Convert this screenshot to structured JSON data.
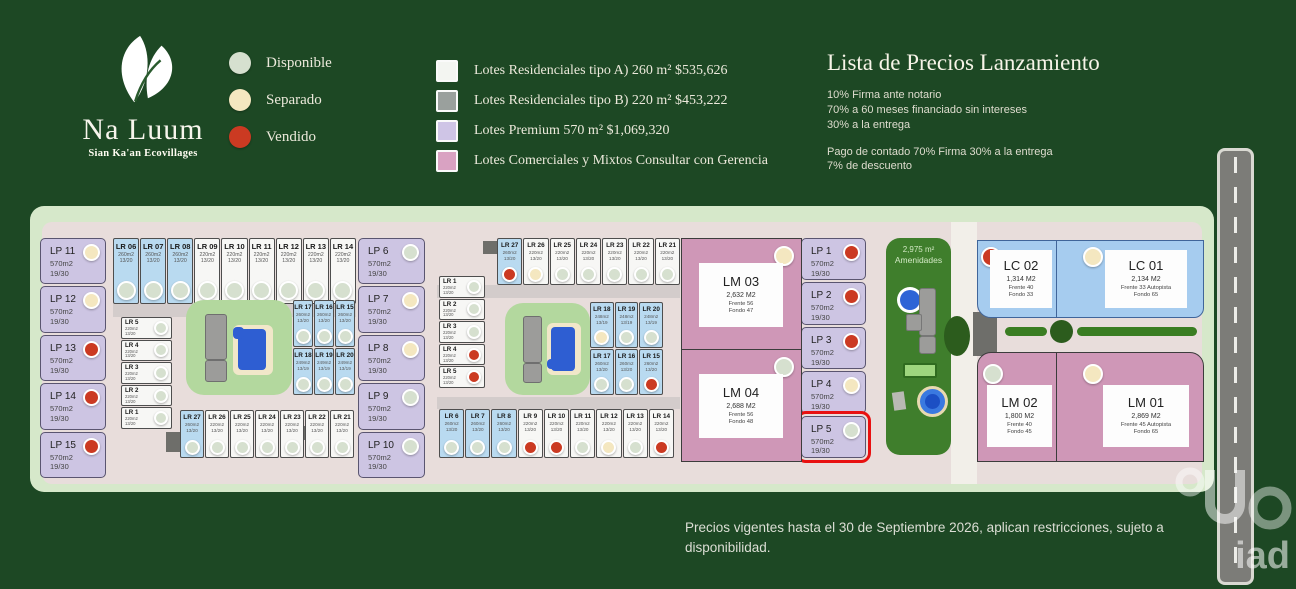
{
  "logo": {
    "title": "Na Luum",
    "subtitle": "Sian Ka'an Ecovillages"
  },
  "status_legend": [
    {
      "label": "Disponible",
      "status": "disponible"
    },
    {
      "label": "Separado",
      "status": "separado"
    },
    {
      "label": "Vendido",
      "status": "vendido"
    }
  ],
  "type_legend": [
    {
      "label": "Lotes Residenciales tipo A)  260 m² $535,626",
      "color": "#f3f5f1"
    },
    {
      "label": "Lotes Residenciales tipo B)  220 m² $453,222",
      "color": "#9aa09d"
    },
    {
      "label": "Lotes Premium 570 m² $1,069,320",
      "color": "#cfc5e6"
    },
    {
      "label": "Lotes Comerciales y Mixtos Consultar con Gerencia",
      "color": "#d9a2c2"
    }
  ],
  "price_list": {
    "title": "Lista de Precios Lanzamiento",
    "lines_1": [
      "10% Firma ante notario",
      "70% a 60 meses  financiado sin intereses",
      "30% a la  entrega"
    ],
    "lines_2": [
      "Pago de contado 70% Firma 30% a la entrega",
      "7% de descuento"
    ]
  },
  "footer": "Precios vigentes hasta el 30 de Septiembre 2026, aplican restricciones, sujeto a disponibilidad.",
  "watermark": "iad",
  "colors": {
    "background": "#1d4824",
    "site": "#d6e8ca",
    "inner_road": "#e8dddb",
    "lp_premium": "#cdc5e3",
    "lr_type_a": "#b9daf0",
    "lr_type_b": "#f7f7f5",
    "commercial_pink": "#cf97b7",
    "commercial_blue": "#a6ccef",
    "amenities_green": "#3f7e2c",
    "disponible": "#d6e0cf",
    "separado": "#f4e7c0",
    "vendido": "#cb3a22",
    "highlight": "#e81010"
  },
  "map": {
    "amenities": {
      "area": "2,975 m²",
      "label": "Amenidades"
    },
    "lp_left": [
      {
        "name": "LP 11",
        "area": "570m2",
        "dims": "19/30",
        "status": "separado"
      },
      {
        "name": "LP 12",
        "area": "570m2",
        "dims": "19/30",
        "status": "separado"
      },
      {
        "name": "LP 13",
        "area": "570m2",
        "dims": "19/30",
        "status": "vendido"
      },
      {
        "name": "LP 14",
        "area": "570m2",
        "dims": "19/30",
        "status": "vendido"
      },
      {
        "name": "LP 15",
        "area": "570m2",
        "dims": "19/30",
        "status": "vendido"
      }
    ],
    "lp_mid": [
      {
        "name": "LP 6",
        "area": "570m2",
        "dims": "19/30",
        "status": "disponible"
      },
      {
        "name": "LP 7",
        "area": "570m2",
        "dims": "19/30",
        "status": "separado"
      },
      {
        "name": "LP 8",
        "area": "570m2",
        "dims": "19/30",
        "status": "separado"
      },
      {
        "name": "LP 9",
        "area": "570m2",
        "dims": "19/30",
        "status": "disponible"
      },
      {
        "name": "LP 10",
        "area": "570m2",
        "dims": "19/30",
        "status": "disponible"
      }
    ],
    "lp_right": [
      {
        "name": "LP 1",
        "area": "570m2",
        "dims": "19/30",
        "status": "vendido"
      },
      {
        "name": "LP 2",
        "area": "570m2",
        "dims": "19/30",
        "status": "vendido"
      },
      {
        "name": "LP 3",
        "area": "570m2",
        "dims": "19/30",
        "status": "vendido"
      },
      {
        "name": "LP 4",
        "area": "570m2",
        "dims": "19/30",
        "status": "separado"
      },
      {
        "name": "LP 5",
        "area": "570m2",
        "dims": "19/30",
        "status": "disponible",
        "highlight": true
      }
    ],
    "b1_top": [
      {
        "name": "LR 06",
        "area": "260m2",
        "dims": "13/20",
        "type": "a",
        "status": "disponible"
      },
      {
        "name": "LR 07",
        "area": "260m2",
        "dims": "13/20",
        "type": "a",
        "status": "disponible"
      },
      {
        "name": "LR 08",
        "area": "260m2",
        "dims": "13/20",
        "type": "a",
        "status": "disponible"
      },
      {
        "name": "LR 09",
        "area": "220m2",
        "dims": "13/20",
        "type": "b",
        "status": "disponible"
      },
      {
        "name": "LR 10",
        "area": "220m2",
        "dims": "13/20",
        "type": "b",
        "status": "disponible"
      },
      {
        "name": "LR 11",
        "area": "220m2",
        "dims": "13/20",
        "type": "b",
        "status": "disponible"
      },
      {
        "name": "LR 12",
        "area": "220m2",
        "dims": "13/20",
        "type": "b",
        "status": "disponible"
      },
      {
        "name": "LR 13",
        "area": "220m2",
        "dims": "13/20",
        "type": "b",
        "status": "disponible"
      },
      {
        "name": "LR 14",
        "area": "220m2",
        "dims": "13/20",
        "type": "b",
        "status": "disponible"
      }
    ],
    "b1_left": [
      {
        "name": "LR 5",
        "area": "220m2",
        "dims": "13/20",
        "type": "b",
        "status": "disponible"
      },
      {
        "name": "LR 4",
        "area": "220m2",
        "dims": "13/20",
        "type": "b",
        "status": "disponible"
      },
      {
        "name": "LR 3",
        "area": "220m2",
        "dims": "13/20",
        "type": "b",
        "status": "disponible"
      },
      {
        "name": "LR 2",
        "area": "220m2",
        "dims": "13/20",
        "type": "b",
        "status": "disponible"
      },
      {
        "name": "LR 1",
        "area": "220m2",
        "dims": "13/20",
        "type": "b",
        "status": "disponible"
      }
    ],
    "b1_right_top": [
      {
        "name": "LR 17",
        "area": "260m2",
        "dims": "13/20",
        "type": "a",
        "status": "disponible"
      },
      {
        "name": "LR 16",
        "area": "260m2",
        "dims": "13/20",
        "type": "a",
        "status": "disponible"
      },
      {
        "name": "LR 15",
        "area": "260m2",
        "dims": "13/20",
        "type": "a",
        "status": "disponible"
      }
    ],
    "b1_right_bottom": [
      {
        "name": "LR 18",
        "area": "249m2",
        "dims": "13/19",
        "type": "a",
        "status": "disponible"
      },
      {
        "name": "LR 19",
        "area": "249m2",
        "dims": "13/19",
        "type": "a",
        "status": "disponible"
      },
      {
        "name": "LR 20",
        "area": "249m2",
        "dims": "13/19",
        "type": "a",
        "status": "disponible"
      }
    ],
    "b1_bottom": [
      {
        "name": "LR 27",
        "area": "260m2",
        "dims": "13/20",
        "type": "a",
        "status": "disponible"
      },
      {
        "name": "LR 26",
        "area": "220m2",
        "dims": "13/20",
        "type": "b",
        "status": "disponible"
      },
      {
        "name": "LR 25",
        "area": "220m2",
        "dims": "13/20",
        "type": "b",
        "status": "disponible"
      },
      {
        "name": "LR 24",
        "area": "220m2",
        "dims": "13/20",
        "type": "b",
        "status": "disponible"
      },
      {
        "name": "LR 23",
        "area": "220m2",
        "dims": "13/20",
        "type": "b",
        "status": "disponible"
      },
      {
        "name": "LR 22",
        "area": "220m2",
        "dims": "13/20",
        "type": "b",
        "status": "disponible"
      },
      {
        "name": "LR 21",
        "area": "220m2",
        "dims": "13/20",
        "type": "b",
        "status": "disponible"
      }
    ],
    "b2_top": [
      {
        "name": "LR 27",
        "area": "260m2",
        "dims": "13/20",
        "type": "a",
        "status": "vendido"
      },
      {
        "name": "LR 26",
        "area": "220m2",
        "dims": "13/20",
        "type": "b",
        "status": "separado"
      },
      {
        "name": "LR 25",
        "area": "220m2",
        "dims": "13/20",
        "type": "b",
        "status": "disponible"
      },
      {
        "name": "LR 24",
        "area": "220m2",
        "dims": "13/20",
        "type": "b",
        "status": "disponible"
      },
      {
        "name": "LR 23",
        "area": "220m2",
        "dims": "13/20",
        "type": "b",
        "status": "disponible"
      },
      {
        "name": "LR 22",
        "area": "220m2",
        "dims": "13/20",
        "type": "b",
        "status": "disponible"
      },
      {
        "name": "LR 21",
        "area": "220m2",
        "dims": "13/20",
        "type": "b",
        "status": "disponible"
      }
    ],
    "b2_left": [
      {
        "name": "LR 1",
        "area": "220m2",
        "dims": "13/20",
        "type": "b",
        "status": "disponible"
      },
      {
        "name": "LR 2",
        "area": "220m2",
        "dims": "13/20",
        "type": "b",
        "status": "disponible"
      },
      {
        "name": "LR 3",
        "area": "220m2",
        "dims": "13/20",
        "type": "b",
        "status": "disponible"
      },
      {
        "name": "LR 4",
        "area": "220m2",
        "dims": "13/20",
        "type": "b",
        "status": "vendido"
      },
      {
        "name": "LR 5",
        "area": "220m2",
        "dims": "13/20",
        "type": "b",
        "status": "vendido"
      }
    ],
    "b2_right_top": [
      {
        "name": "LR 18",
        "area": "248m2",
        "dims": "13/19",
        "type": "a",
        "status": "separado"
      },
      {
        "name": "LR 19",
        "area": "248m2",
        "dims": "13/19",
        "type": "a",
        "status": "disponible"
      },
      {
        "name": "LR 20",
        "area": "248m2",
        "dims": "13/19",
        "type": "a",
        "status": "disponible"
      }
    ],
    "b2_right_bottom": [
      {
        "name": "LR 17",
        "area": "260m2",
        "dims": "13/20",
        "type": "a",
        "status": "disponible"
      },
      {
        "name": "LR 16",
        "area": "260m2",
        "dims": "13/20",
        "type": "a",
        "status": "disponible"
      },
      {
        "name": "LR 15",
        "area": "260m2",
        "dims": "13/20",
        "type": "a",
        "status": "vendido"
      }
    ],
    "b2_bottom": [
      {
        "name": "LR 6",
        "area": "260m2",
        "dims": "13/20",
        "type": "a",
        "status": "disponible"
      },
      {
        "name": "LR 7",
        "area": "260m2",
        "dims": "13/20",
        "type": "a",
        "status": "disponible"
      },
      {
        "name": "LR 8",
        "area": "260m2",
        "dims": "13/20",
        "type": "a",
        "status": "disponible"
      },
      {
        "name": "LR 9",
        "area": "220m2",
        "dims": "13/20",
        "type": "b",
        "status": "vendido"
      },
      {
        "name": "LR 10",
        "area": "220m2",
        "dims": "13/20",
        "type": "b",
        "status": "vendido"
      },
      {
        "name": "LR 11",
        "area": "220m2",
        "dims": "13/20",
        "type": "b",
        "status": "disponible"
      },
      {
        "name": "LR 12",
        "area": "220m2",
        "dims": "13/20",
        "type": "b",
        "status": "separado"
      },
      {
        "name": "LR 13",
        "area": "220m2",
        "dims": "13/20",
        "type": "b",
        "status": "disponible"
      },
      {
        "name": "LR 14",
        "area": "220m2",
        "dims": "13/20",
        "type": "b",
        "status": "vendido"
      }
    ],
    "lm03": {
      "name": "LM 03",
      "area": "2,632 M2",
      "frente": "Frente 56",
      "fondo": "Fondo 47",
      "status": "separado"
    },
    "lm04": {
      "name": "LM 04",
      "area": "2,688 M2",
      "frente": "Frente 56",
      "fondo": "Fondo 48",
      "status": "disponible"
    },
    "lc02": {
      "name": "LC 02",
      "area": "1,314 M2",
      "frente": "Frente 40",
      "fondo": "Fondo 33",
      "status": "vendido"
    },
    "lc01": {
      "name": "LC 01",
      "area": "2,134 M2",
      "frente": "Frente 33 Autopista",
      "fondo": "Fondo 65",
      "status": "separado"
    },
    "lm02": {
      "name": "LM 02",
      "area": "1,800 M2",
      "frente": "Frente 40",
      "fondo": "Fondo 45",
      "status": "disponible"
    },
    "lm01": {
      "name": "LM 01",
      "area": "2,869 M2",
      "frente": "Frente 45 Autopista",
      "fondo": "Fondo 65",
      "status": "separado"
    }
  }
}
